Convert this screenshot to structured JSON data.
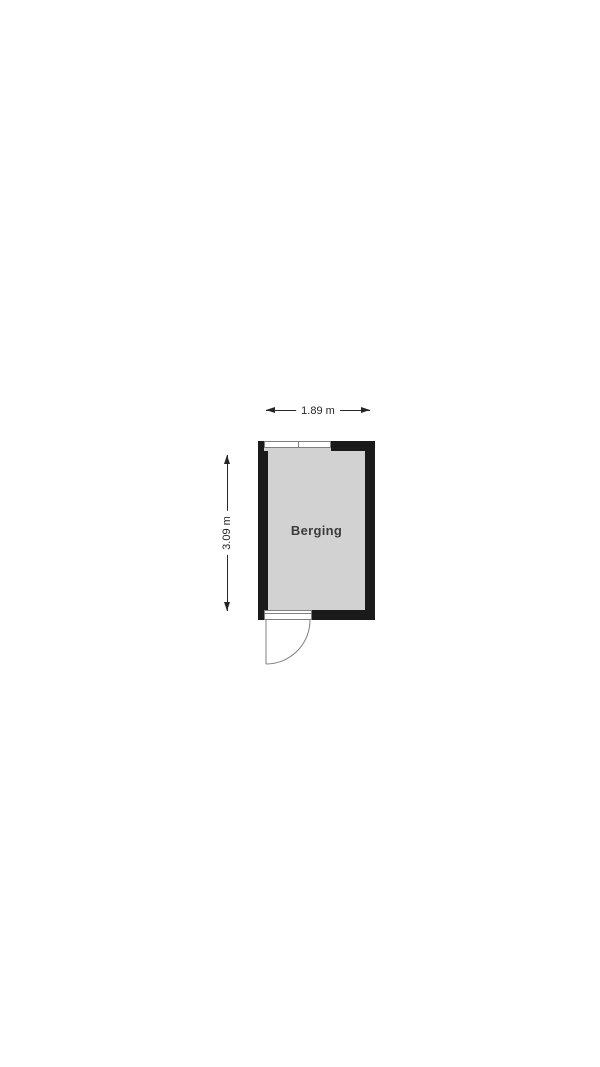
{
  "floorplan": {
    "room": {
      "name": "Berging"
    },
    "dimensions": {
      "width": "1.89 m",
      "height": "3.09 m"
    },
    "icons": {
      "window": "window-icon",
      "door": "door-swing-icon",
      "arrows": [
        "arrow-left-icon",
        "arrow-right-icon",
        "arrow-up-icon",
        "arrow-down-icon"
      ]
    },
    "colors": {
      "background": "#ffffff",
      "wall": "#1a1a1a",
      "floor": "#d2d2d2",
      "dimension": "#262626",
      "symbol": "#7f7f7f",
      "room_text": "#3c3c3c"
    }
  }
}
